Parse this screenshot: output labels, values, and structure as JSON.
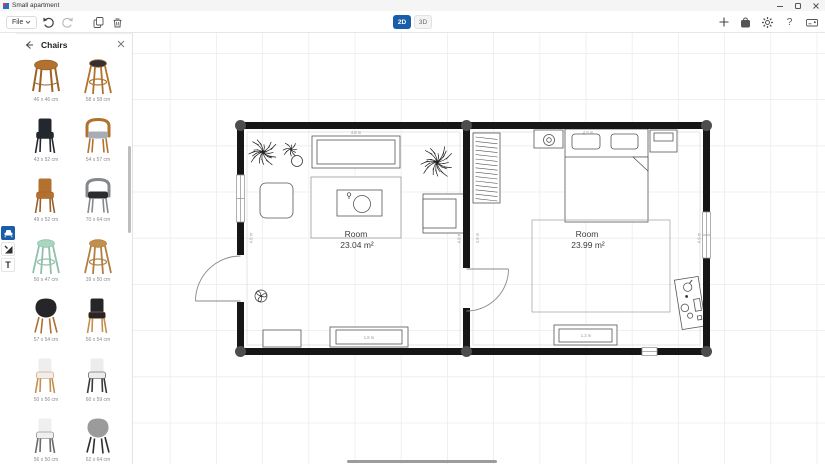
{
  "window": {
    "title": "Small apartment"
  },
  "toolbar": {
    "file": "File",
    "view2d": "2D",
    "view3d": "3D"
  },
  "icons": {
    "help_glyph": "?",
    "text_tool_glyph": "T"
  },
  "panel": {
    "title": "Chairs",
    "items": [
      {
        "label": "46 x 46 cm",
        "kind": "stool",
        "seat": "#b2712e",
        "frame": "#9c6327"
      },
      {
        "label": "58 x 58 cm",
        "kind": "barstool",
        "seat": "#303036",
        "frame": "#b2712e"
      },
      {
        "label": "43 x 52 cm",
        "kind": "chair",
        "seat": "#23272e",
        "frame": "#23272e"
      },
      {
        "label": "54 x 57 cm",
        "kind": "armchair",
        "seat": "#a8adb5",
        "frame": "#b2712e"
      },
      {
        "label": "49 x 52 cm",
        "kind": "chair",
        "seat": "#b2712e",
        "frame": "#9a5f28"
      },
      {
        "label": "70 x 64 cm",
        "kind": "armchair",
        "seat": "#2c2c2e",
        "frame": "#84898e"
      },
      {
        "label": "50 x 47 cm",
        "kind": "barstool",
        "seat": "#a8d6c0",
        "frame": "#8fc0a9"
      },
      {
        "label": "39 x 50 cm",
        "kind": "barstool",
        "seat": "#c38f50",
        "frame": "#b27f42"
      },
      {
        "label": "57 x 54 cm",
        "kind": "shell",
        "seat": "#26262a",
        "frame": "#b2712e"
      },
      {
        "label": "56 x 54 cm",
        "kind": "chair",
        "seat": "#26262a",
        "frame": "#c38f50"
      },
      {
        "label": "50 x 56 cm",
        "kind": "chair",
        "seat": "#efeeec",
        "frame": "#c38f50"
      },
      {
        "label": "60 x 59 cm",
        "kind": "chair",
        "seat": "#ececec",
        "frame": "#3a3a3c"
      },
      {
        "label": "56 x 50 cm",
        "kind": "chair",
        "seat": "#efefef",
        "frame": "#6a6a6e"
      },
      {
        "label": "62 x 64 cm",
        "kind": "shell",
        "seat": "#9b9b9b",
        "frame": "#2e2e30"
      }
    ]
  },
  "plan": {
    "room_left": {
      "name": "Room",
      "area": "23.04 m²",
      "side_dim": "4.8 m",
      "top_dim": "4.8 m"
    },
    "room_right": {
      "name": "Room",
      "area": "23.99 m²",
      "side_dim": "4.9 m",
      "top_dim": "4.9 m"
    },
    "dims": {
      "sideboard_bottom": "1.8 m",
      "dresser_bottom": "1.3 m"
    }
  },
  "colors": {
    "accent": "#1a5dab",
    "wall": "#161616",
    "grid": "#ececec"
  }
}
